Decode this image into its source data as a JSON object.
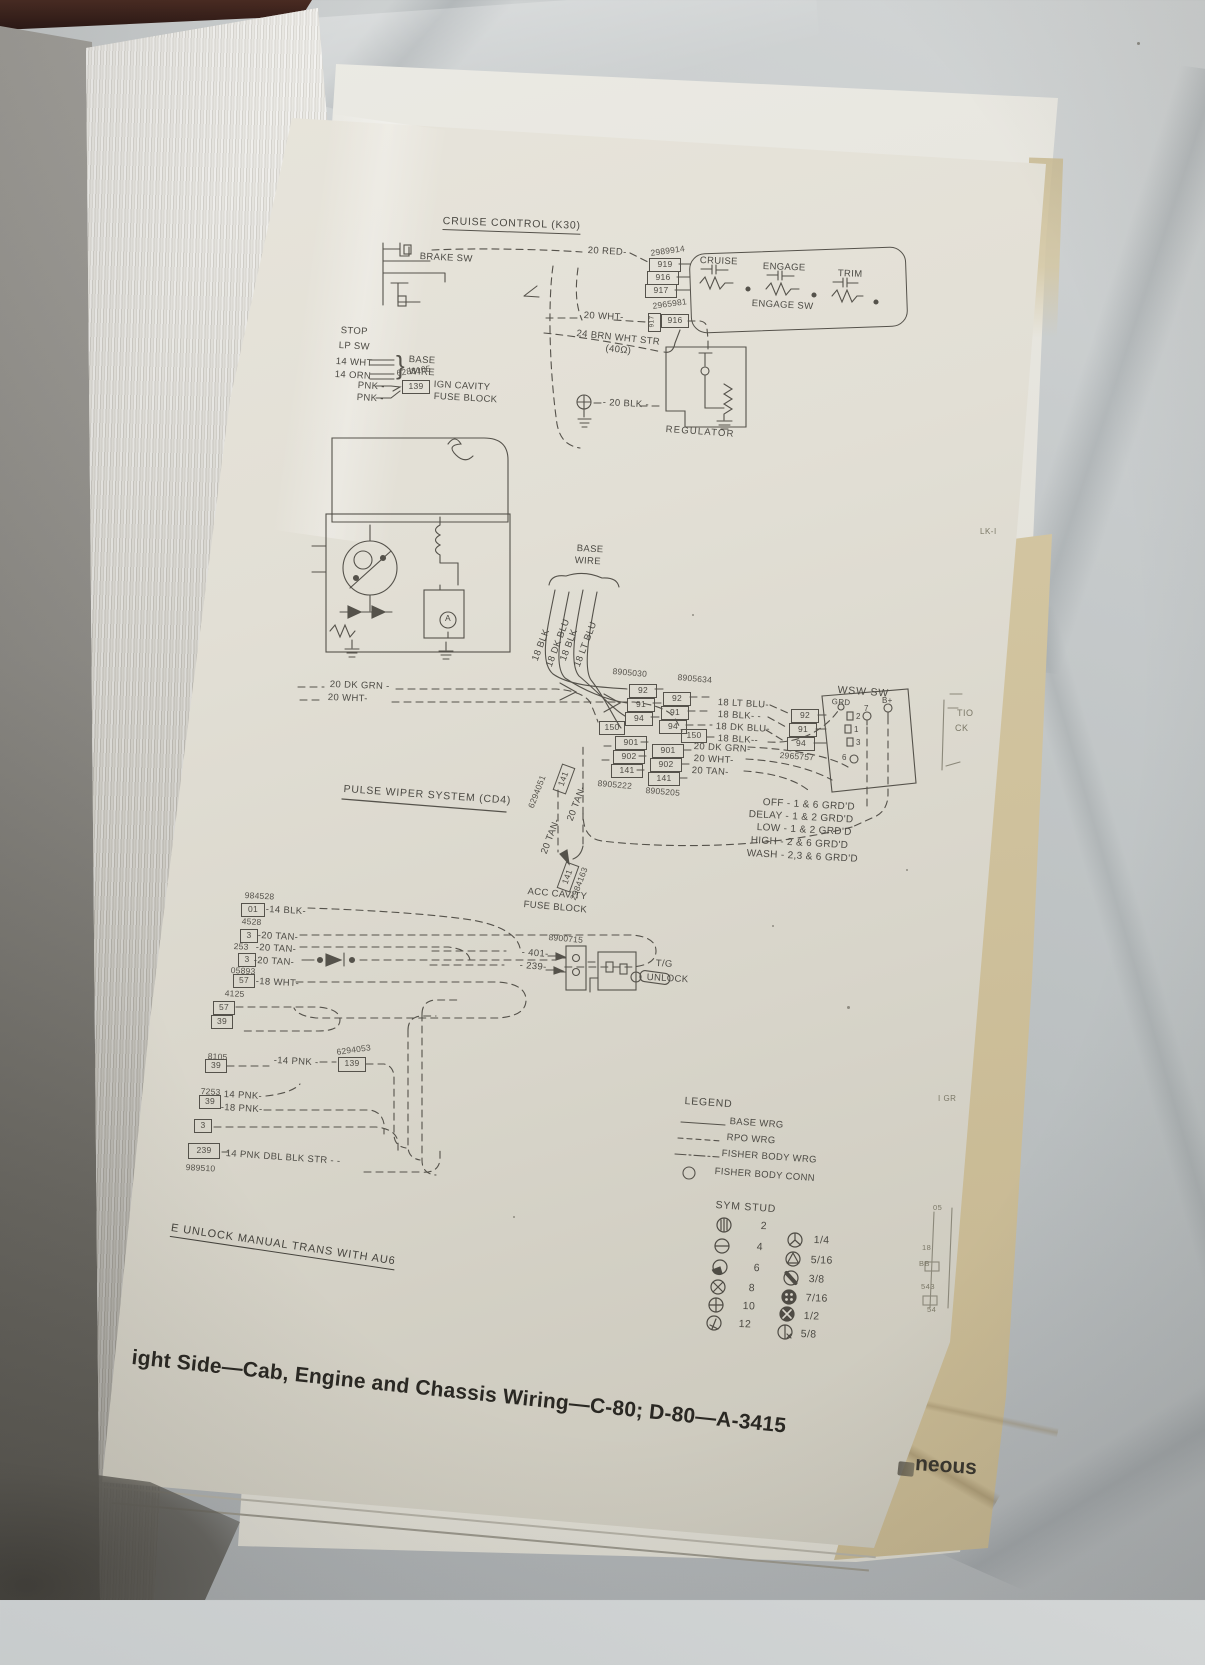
{
  "cruise": {
    "title": "CRUISE CONTROL (K30)",
    "brake_sw": "BRAKE SW",
    "wire_red": "20 RED-",
    "part_a": "2989914",
    "conn_a": [
      "919",
      "916",
      "917"
    ],
    "sw_cruise": "CRUISE",
    "sw_engage": "ENGAGE",
    "sw_trim": "TRIM",
    "engage_sw": "ENGAGE SW",
    "wire_wht": "20 WHT-",
    "part_b": "2965981",
    "conn_b_side": "917",
    "conn_b": "916",
    "wire_brn": "24 BRN WHT STR",
    "ohm": "(40Ω)",
    "stop": "STOP",
    "lp_sw": "LP SW",
    "w14wht": "14 WHT",
    "w14orn": "14 ORN",
    "brace": "}",
    "base": "BASE",
    "wire": "WIRE",
    "pnk1": "PNK -",
    "pnk2": "PNK -",
    "part_c": "6288105",
    "conn_139": "139",
    "ign": "IGN CAVITY",
    "fuse": "FUSE BLOCK",
    "wire_blk": "- 20 BLK -",
    "regulator": "REGULATOR"
  },
  "wiper": {
    "base": "BASE",
    "wire": "WIRE",
    "amp": "A",
    "vwires": [
      "18 BLK",
      "18 DK BLU",
      "18 BLK",
      "18 LT BLU"
    ],
    "part_30": "8905030",
    "part_34": "8905634",
    "stackA": [
      "92",
      "91",
      "94"
    ],
    "p150a": "150",
    "stackB": [
      "92",
      "91",
      "94"
    ],
    "p150b": "150",
    "mid": [
      "18 LT BLU-",
      "18 BLK- -",
      "18 DK BLU-",
      "18 BLK--"
    ],
    "stackC": [
      "92",
      "91",
      "94"
    ],
    "part_57": "2965757",
    "wsw": "WSW SW",
    "grd": "GRD",
    "sq": [
      "2",
      "1",
      "3"
    ],
    "p7": "7",
    "pb": "B+",
    "p6": "6",
    "stackD": [
      "901",
      "902",
      "141"
    ],
    "stackE": [
      "901",
      "902",
      "141"
    ],
    "part_22": "8905222",
    "part_05": "8905205",
    "low": [
      "20 DK GRN-",
      "20 WHT-",
      "20 TAN-"
    ],
    "left1": "20 DK GRN -",
    "left2": "20 WHT-",
    "positions": [
      "OFF - 1 & 6 GRD'D",
      "DELAY - 1 & 2 GRD'D",
      "LOW - 1 & 2 GRD'D",
      "HIGH - 2 & 6 GRD'D",
      "WASH - 2,3 & 6 GRD'D"
    ],
    "header": "PULSE WIPER SYSTEM (CD4)",
    "tan1": "20 TAN-",
    "tan2": "20 TAN-",
    "part_6294051": "6294051",
    "c141a": "141",
    "c141b": "141",
    "part_2984163": "2984163",
    "acc1": "ACC CAVITY",
    "acc2": "FUSE BLOCK"
  },
  "tg": {
    "part": "8900715",
    "w401": "- 401-",
    "w239": "- 239-",
    "l1": "T/G",
    "l2": "UNLOCK"
  },
  "cluster": {
    "rows": [
      {
        "part": "984528",
        "pin": "01",
        "wire": "-14 BLK-"
      },
      {
        "part": "4528",
        "pin": "3",
        "wire": "-20 TAN-"
      },
      {
        "part": "253",
        "wire": "-20 TAN-"
      },
      {
        "part": "05893",
        "pin": "3",
        "wire": "-20 TAN-"
      },
      {
        "part": "4125",
        "pin": "57",
        "wire": "-18 WHT-"
      },
      {
        "pin_a": "57",
        "pin_b": "39"
      },
      {
        "part": "8105",
        "pin": "39",
        "wire": "-14 PNK -",
        "conn": "139",
        "conn_part": "6294053"
      },
      {
        "part": "7253",
        "pin": "39",
        "wire_a": "14 PNK-",
        "wire_b": "-18 PNK-"
      },
      {
        "pin": "3"
      },
      {
        "part": "989510",
        "pin": "239",
        "wire": "14 PNK DBL BLK STR - -"
      }
    ]
  },
  "legend": {
    "title": "LEGEND",
    "items": [
      "BASE WRG",
      "RPO WRG",
      "FISHER BODY WRG",
      "FISHER BODY CONN"
    ]
  },
  "stud": {
    "title": "SYM STUD",
    "nums": [
      "2",
      "4",
      "6",
      "8",
      "10",
      "12"
    ],
    "fracs": [
      "1/4",
      "5/16",
      "3/8",
      "7/16",
      "1/2",
      "5/8"
    ]
  },
  "footer": {
    "note": "E UNLOCK MANUAL TRANS WITH AU6",
    "title": "ight Side—Cab, Engine and Chassis Wiring—C-80; D-80—A-3415",
    "underlay": "neous"
  },
  "fragments": {
    "lk": "LK-I",
    "tio": "TIO",
    "ck": "CK",
    "igr": "I GR",
    "f05": "05",
    "f18": "18",
    "fbb": "BB",
    "f543": "543",
    "f54": "54"
  }
}
